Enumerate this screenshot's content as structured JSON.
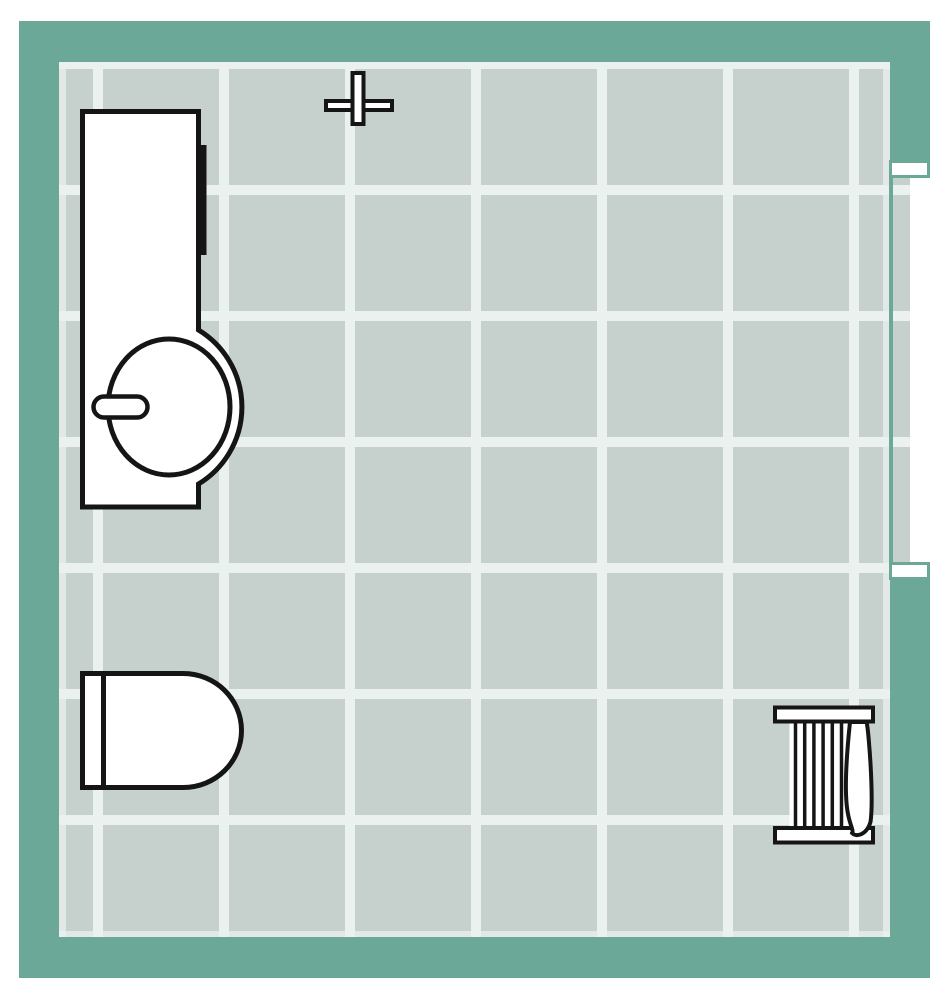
{
  "canvas": {
    "type": "floor-plan",
    "room": "bathroom",
    "width_px": 951,
    "height_px": 1000
  },
  "colors": {
    "wall": "#6CA897",
    "tile": "#C6D1CE",
    "grout": "#EBF1EF",
    "fixture_fill": "#FFFFFF",
    "fixture_line": "#151515",
    "background": "#FFFFFF"
  },
  "room": {
    "wall_thickness_px": 40,
    "tile_pitch_px": 126,
    "door": {
      "wall": "right",
      "type": "open-doorway",
      "opening_top_px": 178,
      "opening_bottom_px": 562
    },
    "fixtures": [
      {
        "id": "vanity-unit",
        "label": "Vanity counter with round basin, tap and wall bar",
        "position": "top-left"
      },
      {
        "id": "cross-marker",
        "label": "Cross marker (light / fitting point)",
        "position": "top-center-left"
      },
      {
        "id": "toilet",
        "label": "Toilet with cistern",
        "position": "bottom-left"
      },
      {
        "id": "towel-radiator",
        "label": "Towel radiator with hanging towel",
        "position": "bottom-right"
      }
    ]
  }
}
